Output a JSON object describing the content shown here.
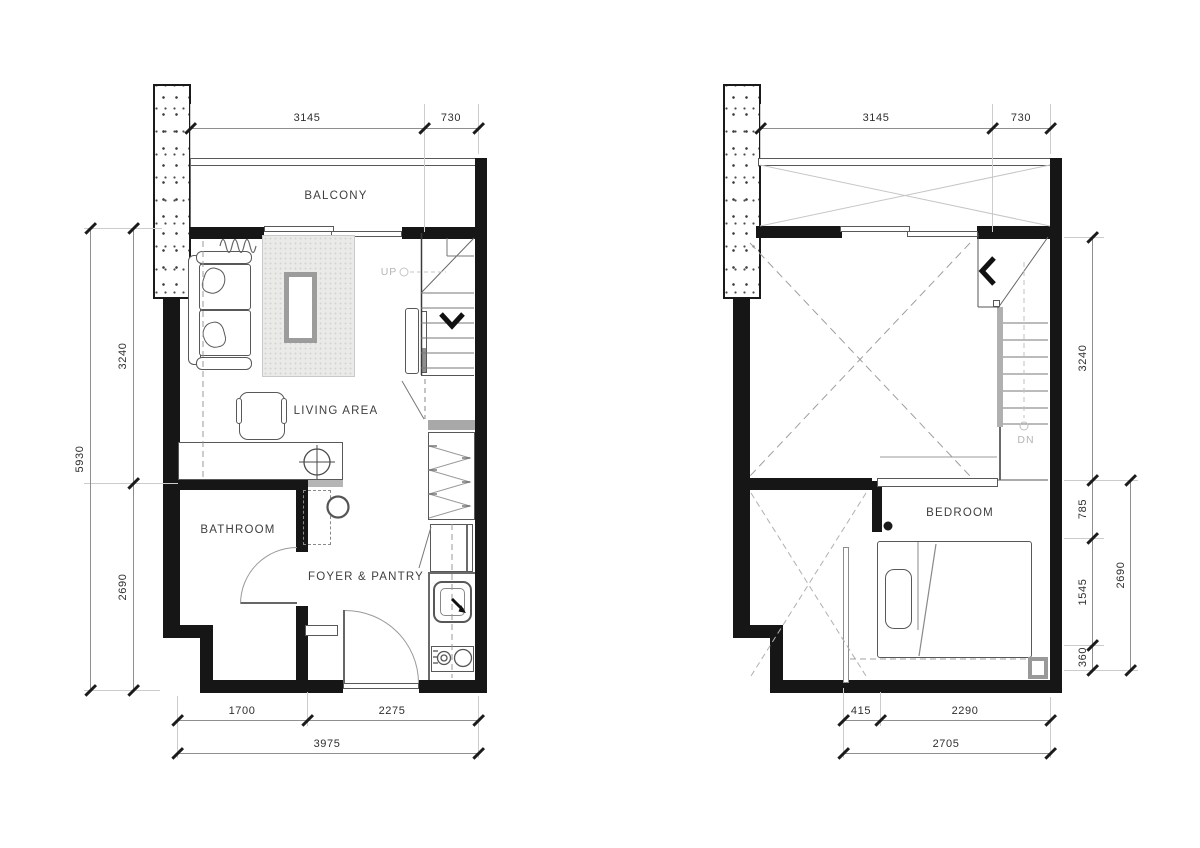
{
  "drawing": {
    "left_plan": {
      "labels": {
        "balcony": "BALCONY",
        "living_area": "LIVING AREA",
        "bathroom": "BATHROOM",
        "foyer_pantry": "FOYER & PANTRY",
        "stair": "UP"
      },
      "dims": {
        "top": [
          "3145",
          "730"
        ],
        "side_overall": "5930",
        "side": [
          "3240",
          "2690"
        ],
        "bottom": [
          "1700",
          "2275"
        ],
        "bottom_overall": "3975"
      }
    },
    "right_plan": {
      "labels": {
        "bedroom": "BEDROOM",
        "stair": "DN"
      },
      "dims": {
        "top": [
          "3145",
          "730"
        ],
        "side": [
          "3240",
          "785",
          "1545",
          "360"
        ],
        "side_overall": "2690",
        "bottom": [
          "415",
          "2290"
        ],
        "bottom_overall": "2705"
      }
    },
    "colors": {
      "wall": "#161616",
      "furniture_line": "#585858",
      "dimension_line": "#8f8f8f",
      "text": "#2e2e2e",
      "light_text": "#b4b4b4",
      "rug_fill": "#eaeae8"
    }
  }
}
